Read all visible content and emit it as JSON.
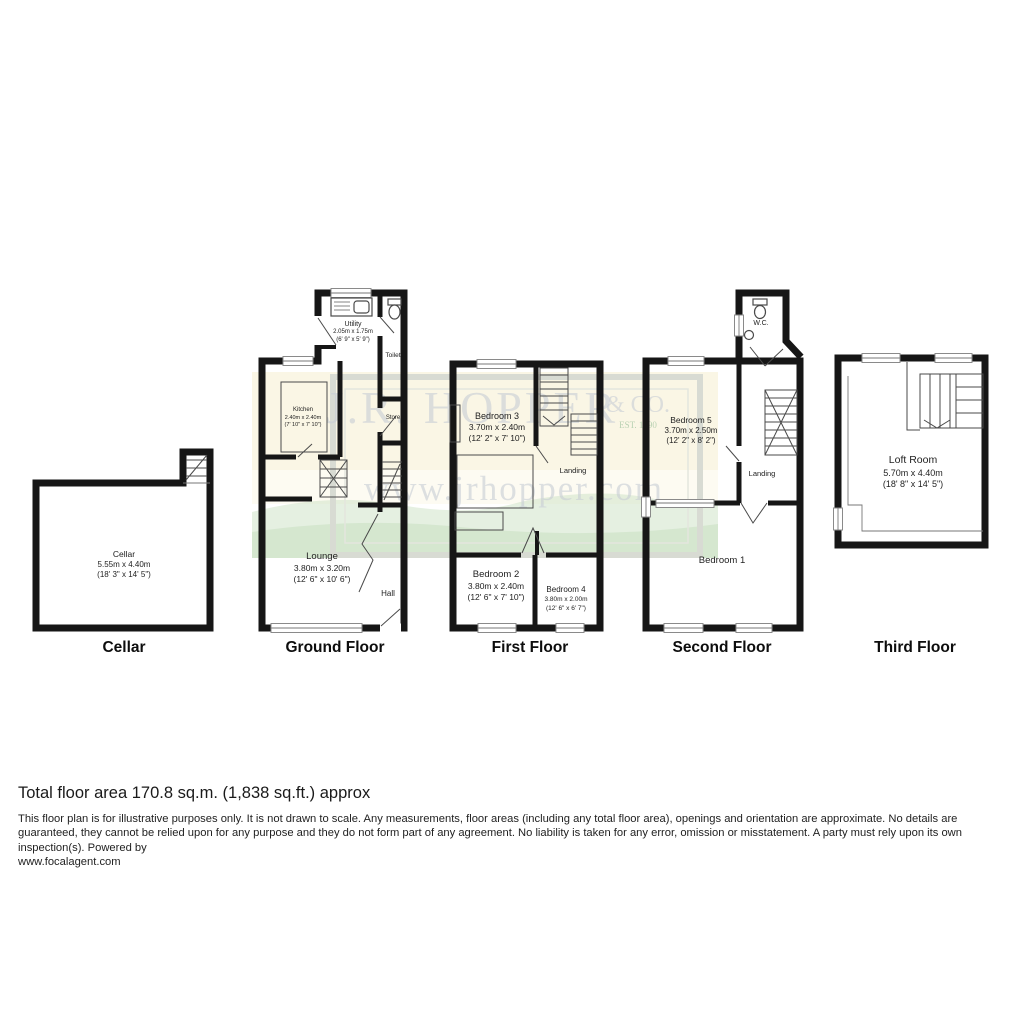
{
  "floors": [
    {
      "label": "Cellar"
    },
    {
      "label": "Ground Floor"
    },
    {
      "label": "First Floor"
    },
    {
      "label": "Second Floor"
    },
    {
      "label": "Third Floor"
    }
  ],
  "rooms": {
    "cellar": {
      "name": "Cellar",
      "metric": "5.55m x 4.40m",
      "imperial": "(18' 3\" x 14' 5\")"
    },
    "utility": {
      "name": "Utility",
      "metric": "2.05m x 1.75m",
      "imperial": "(6' 9\" x 5' 9\")"
    },
    "toilet": {
      "name": "Toilet"
    },
    "kitchen": {
      "name": "Kitchen",
      "metric": "2.40m x 2.40m",
      "imperial": "(7' 10\" x 7' 10\")"
    },
    "store": {
      "name": "Store"
    },
    "lounge": {
      "name": "Lounge",
      "metric": "3.80m x 3.20m",
      "imperial": "(12' 6\" x 10' 6\")"
    },
    "hall": {
      "name": "Hall"
    },
    "bedroom3": {
      "name": "Bedroom 3",
      "metric": "3.70m x 2.40m",
      "imperial": "(12' 2\" x 7' 10\")"
    },
    "landing1": {
      "name": "Landing"
    },
    "bedroom2": {
      "name": "Bedroom 2",
      "metric": "3.80m x 2.40m",
      "imperial": "(12' 6\" x 7' 10\")"
    },
    "bedroom4": {
      "name": "Bedroom 4",
      "metric": "3.80m x 2.00m",
      "imperial": "(12' 6\" x 6' 7\")"
    },
    "wc": {
      "name": "W.C."
    },
    "bedroom5": {
      "name": "Bedroom 5",
      "metric": "3.70m x 2.50m",
      "imperial": "(12' 2\" x 8' 2\")"
    },
    "landing2": {
      "name": "Landing"
    },
    "bedroom1": {
      "name": "Bedroom 1"
    },
    "loft": {
      "name": "Loft Room",
      "metric": "5.70m x 4.40m",
      "imperial": "(18' 8\" x 14' 5\")"
    }
  },
  "watermark": {
    "name": "J.R. HOPPER",
    "suffix": "& CO.",
    "established": "EST. 1890",
    "url": "www.jrhopper.com"
  },
  "footer": {
    "total_area": "Total floor area 170.8 sq.m. (1,838 sq.ft.) approx",
    "disclaimer": "This floor plan is for illustrative purposes only. It is not drawn to scale. Any measurements, floor areas (including any total floor area), openings and orientation are approximate. No details are guaranteed, they cannot be relied upon for any purpose and they do not form part of any agreement. No liability is taken for any error, omission or misstatement. A party must rely upon its own inspection(s). Powered by",
    "powered_by_url": "www.focalagent.com"
  },
  "colors": {
    "walls": "#161616",
    "watermark_gray": "#c9ced6",
    "watermark_yellow": "#f6eecb",
    "watermark_green": "#cfe3c8"
  }
}
